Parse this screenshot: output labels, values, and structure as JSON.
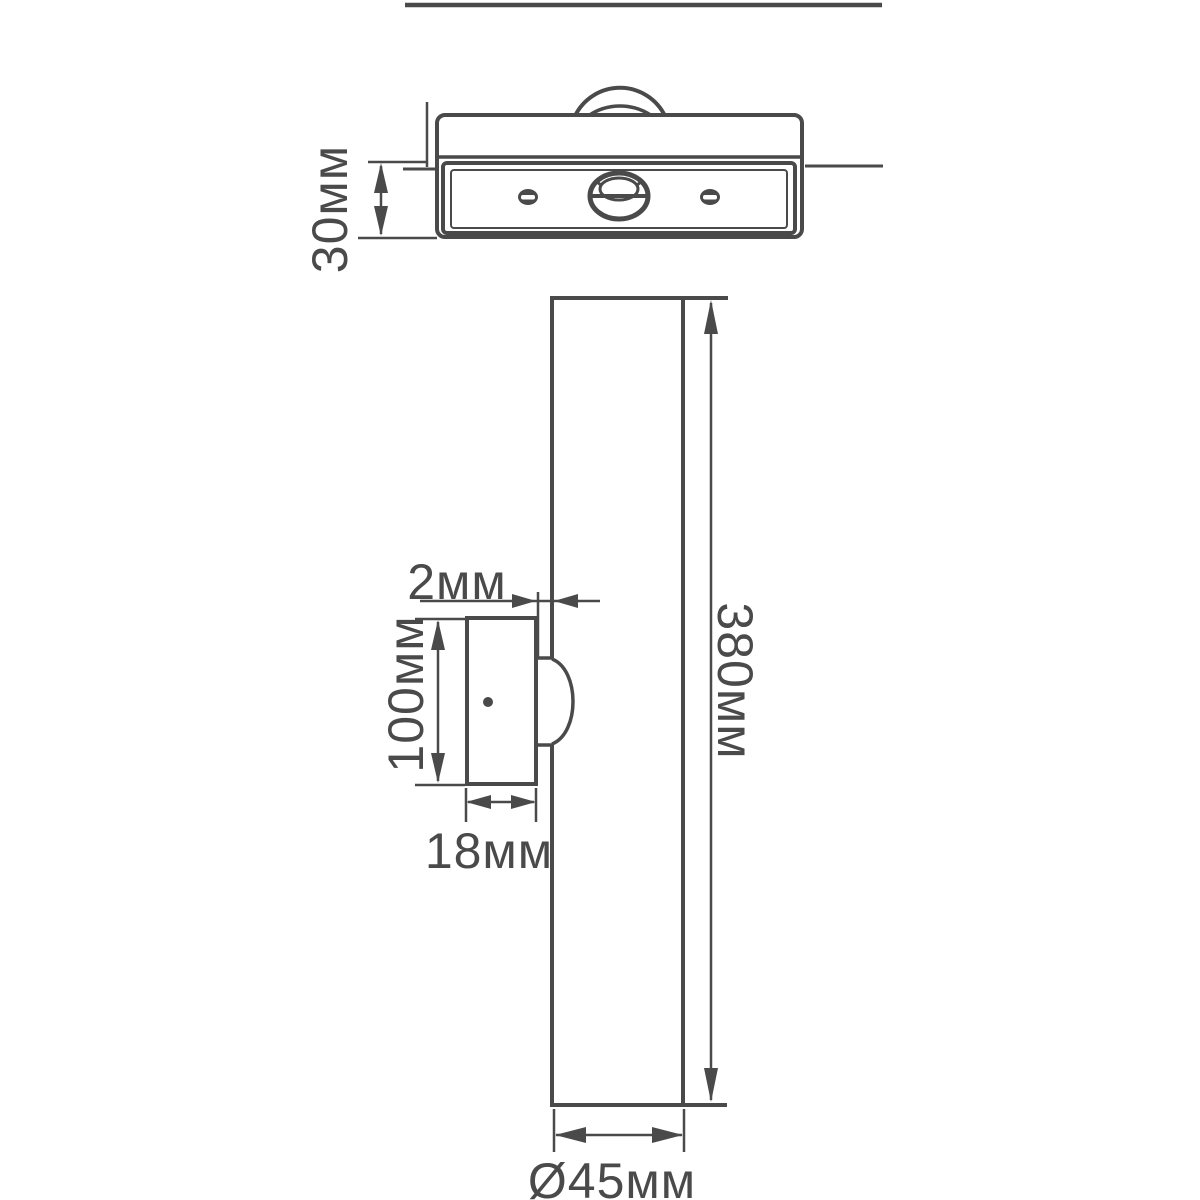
{
  "drawing": {
    "type": "technical-dimension-drawing",
    "subject": "linear wall lamp, top view and side view",
    "units": "mm"
  },
  "dimensions": {
    "body_depth": "30мм",
    "wall_gap": "2мм",
    "bracket_height": "100мм",
    "bracket_width": "18мм",
    "tube_length": "380мм",
    "tube_diameter": "Ø45мм"
  },
  "colors": {
    "line": "#4a4a4a",
    "background": "#ffffff"
  }
}
